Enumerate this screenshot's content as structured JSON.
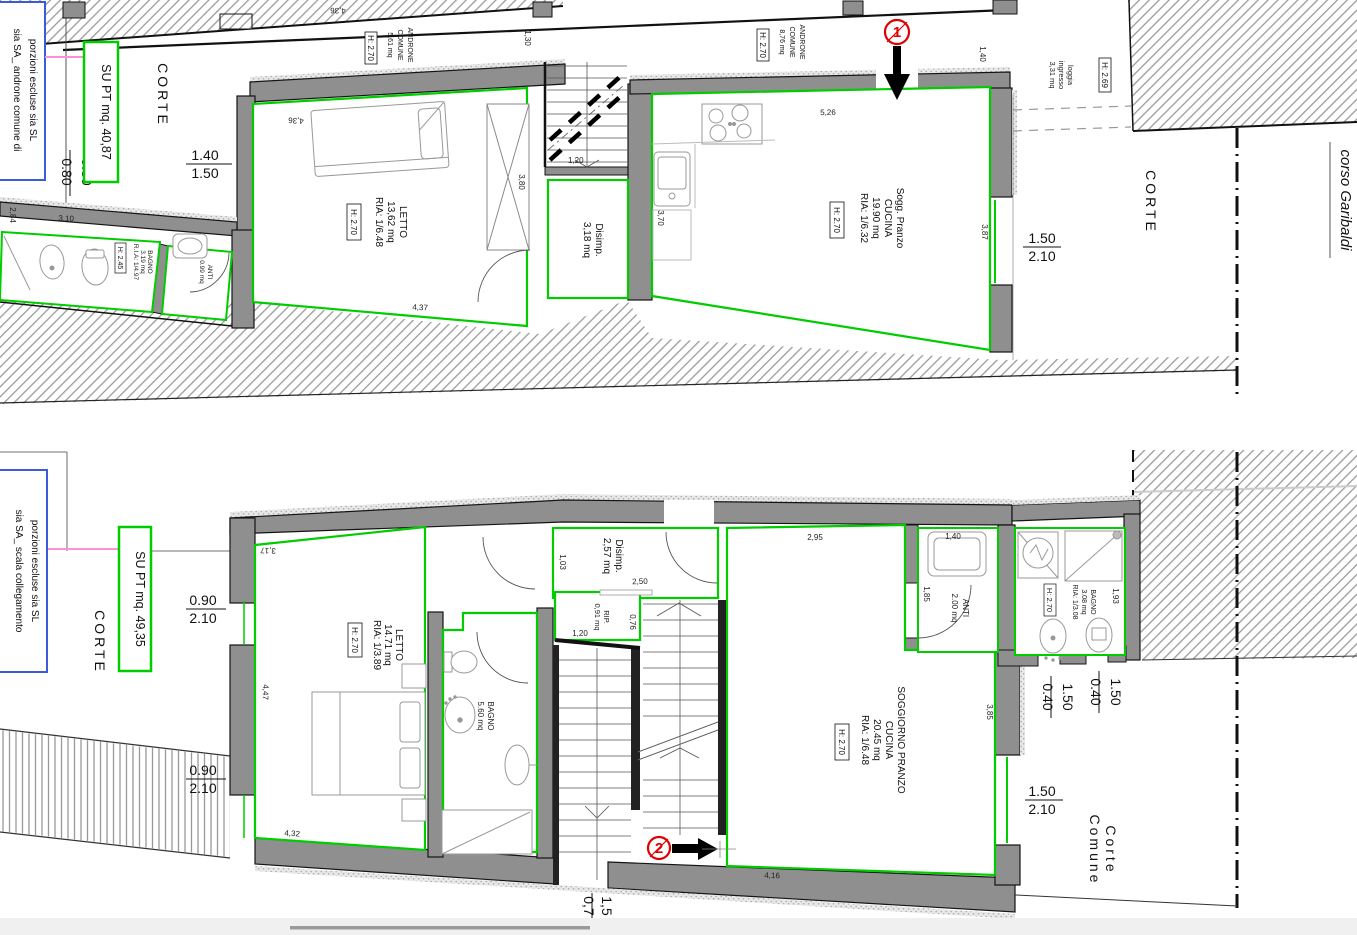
{
  "colors": {
    "wall": "#8f8f8f",
    "room_outline": "#00cc00",
    "excluded_box_border": "#3b5bdb",
    "link_line": "#ff8fd8",
    "marker_red": "#e00000",
    "hatch_stroke": "#9b9b9b",
    "bottom_strip": "#f0f0f0",
    "scrollbar": "#9a9a9a"
  },
  "upper_plan": {
    "title_box": "SU PT mq. 40,87",
    "excluded_note": {
      "line1": "porzioni escluse sia SL",
      "line2": "sia SA_ androne comune di"
    },
    "corte_left": "CORTE",
    "corte_right": "CORTE",
    "street": "corso Garibaldi",
    "marker": "1",
    "androne_left": {
      "name": "ANDRONE",
      "name2": "COMUNE",
      "area": "5,61 mq",
      "height": "H: 2.70"
    },
    "androne_right": {
      "name": "ANDRONE",
      "name2": "COMUNE",
      "area": "8,76 mq",
      "height": "H: 2.70"
    },
    "letto": {
      "name": "LETTO",
      "area": "13,62 mq",
      "ria": "RIA: 1/6.48",
      "height": "H: 2.70"
    },
    "disimp": {
      "name": "Disimp.",
      "area": "3,18 mq"
    },
    "soggiorno": {
      "name": "Sogg. Pranzo",
      "name2": "CUCINA",
      "area": "19.90 mq",
      "ria": "RIA: 1/6.32",
      "height": "H: 2.70"
    },
    "bagno": {
      "name": "BAGNO",
      "area": "3.19 mq",
      "ria": "R.I.A: 1/4.97",
      "height": "H: 2.45"
    },
    "anti": {
      "name": "ANTI",
      "area": "0.99 mq"
    },
    "loggia": {
      "name": "loggia",
      "name2": "ingresso",
      "area": "3,31 mq",
      "height": "H: 2.69"
    },
    "dims": {
      "corridor_len": "4,36",
      "corridor_w": "1,30",
      "letto_w": "4,36",
      "letto_h": "2,84",
      "letto_bottom": "4,37",
      "wardrobe": "3,80",
      "bath_len": "3,10",
      "stair_w": "1,20",
      "cucina_top": "5,26",
      "cucina_left": "3,70",
      "cucina_right": "3,87",
      "entry": "1,40",
      "f_gate": {
        "a": "1.40",
        "b": "1.50"
      },
      "f_left": {
        "a": "0.80",
        "b": "0.80"
      },
      "f_window": {
        "a": "1.50",
        "b": "2.10"
      }
    }
  },
  "lower_plan": {
    "title_box": "SU PT mq. 49,35",
    "excluded_note": {
      "line1": "porzioni escluse sia SL",
      "line2": "sia SA_ scala collegamento"
    },
    "corte": "CORTE",
    "corte_comune": {
      "line1": "Corte",
      "line2": "Comune"
    },
    "marker": "2",
    "letto": {
      "name": "LETTO",
      "area": "14.71 mq",
      "ria": "RIA: 1/3.89",
      "height": "H: 2.70"
    },
    "disimp": {
      "name": "Disimp.",
      "area": "2,57 mq"
    },
    "rip": {
      "name": "RIP.",
      "area": "0,91 mq"
    },
    "bagno_grande": {
      "name": "BAGNO",
      "area": "5.60 mq"
    },
    "soggiorno": {
      "name": "SOGGIORNO PRANZO",
      "name2": "CUCINA",
      "area": "20.45 mq",
      "ria": "RIA: 1/6.48",
      "height": "H: 2.70"
    },
    "anti": {
      "name": "ANTI",
      "area": "2.00 mq"
    },
    "bagno_piccolo": {
      "name": "BAGNO",
      "area": "3.08 mq",
      "ria": "RIA: 1/3.08",
      "height": "H: 2.70"
    },
    "dims": {
      "top_left": "3,17",
      "disimp_h": "1,03",
      "disimp_w": "2,50",
      "sogg_top": "2,95",
      "rip_h": "0,76",
      "rip_w": "1,20",
      "letto_left": "4,47",
      "letto_bottom": "4,32",
      "anti_top": "1,40",
      "anti_left": "1,85",
      "bagno_right": "1,93",
      "sogg_right": "3,85",
      "sogg_bottom": "4,16",
      "f_win1": {
        "a": "0.90",
        "b": "2.10"
      },
      "f_win2": {
        "a": "0.90",
        "b": "2.10"
      },
      "f_door1": {
        "a": "0.40",
        "b": "1.50"
      },
      "f_door2": {
        "a": "0.40",
        "b": "1.50"
      },
      "f_win3": {
        "a": "1.50",
        "b": "2.10"
      },
      "f_exit": {
        "a": "0,7",
        "b": "1,5"
      }
    }
  }
}
